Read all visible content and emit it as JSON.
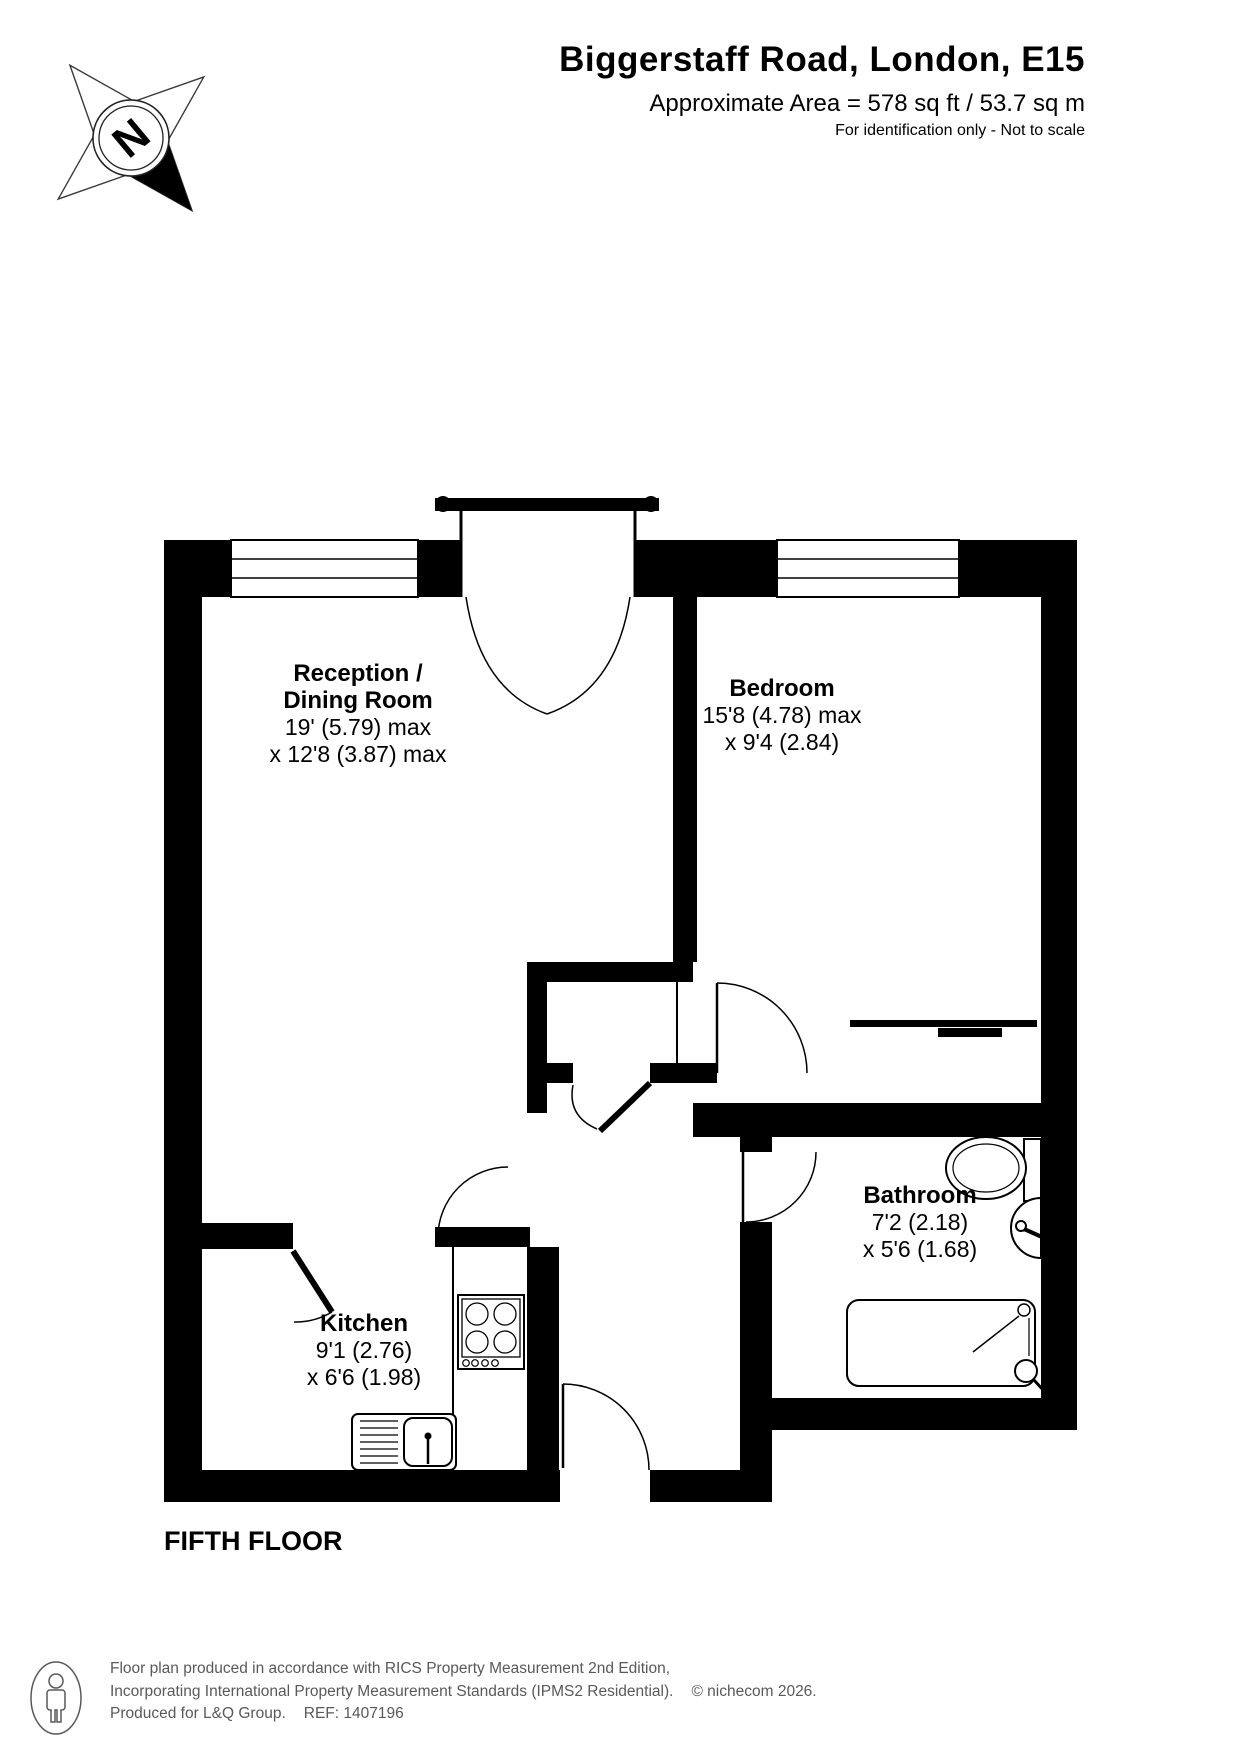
{
  "header": {
    "title": "Biggerstaff Road, London, E15",
    "area": "Approximate Area = 578 sq ft / 53.7 sq m",
    "note": "For identification only - Not to scale"
  },
  "compass": {
    "north_label": "N"
  },
  "rooms": {
    "reception": {
      "name1": "Reception /",
      "name2": "Dining Room",
      "dim1": "19' (5.79) max",
      "dim2": "x 12'8 (3.87) max"
    },
    "bedroom": {
      "name": "Bedroom",
      "dim1": "15'8 (4.78) max",
      "dim2": "x 9'4 (2.84)"
    },
    "bathroom": {
      "name": "Bathroom",
      "dim1": "7'2 (2.18)",
      "dim2": "x 5'6 (1.68)"
    },
    "kitchen": {
      "name": "Kitchen",
      "dim1": "9'1 (2.76)",
      "dim2": "x 6'6 (1.98)"
    }
  },
  "floor_label": "FIFTH FLOOR",
  "footer": {
    "line1": "Floor plan produced in accordance with RICS Property Measurement 2nd Edition,",
    "line2": "Incorporating International Property Measurement Standards (IPMS2 Residential).",
    "copyright": "© nichecom 2026.",
    "line3": "Produced for L&Q Group.",
    "ref": "REF: 1407196"
  },
  "colors": {
    "wall": "#000000",
    "footer_text": "#58595b",
    "background": "#ffffff"
  }
}
